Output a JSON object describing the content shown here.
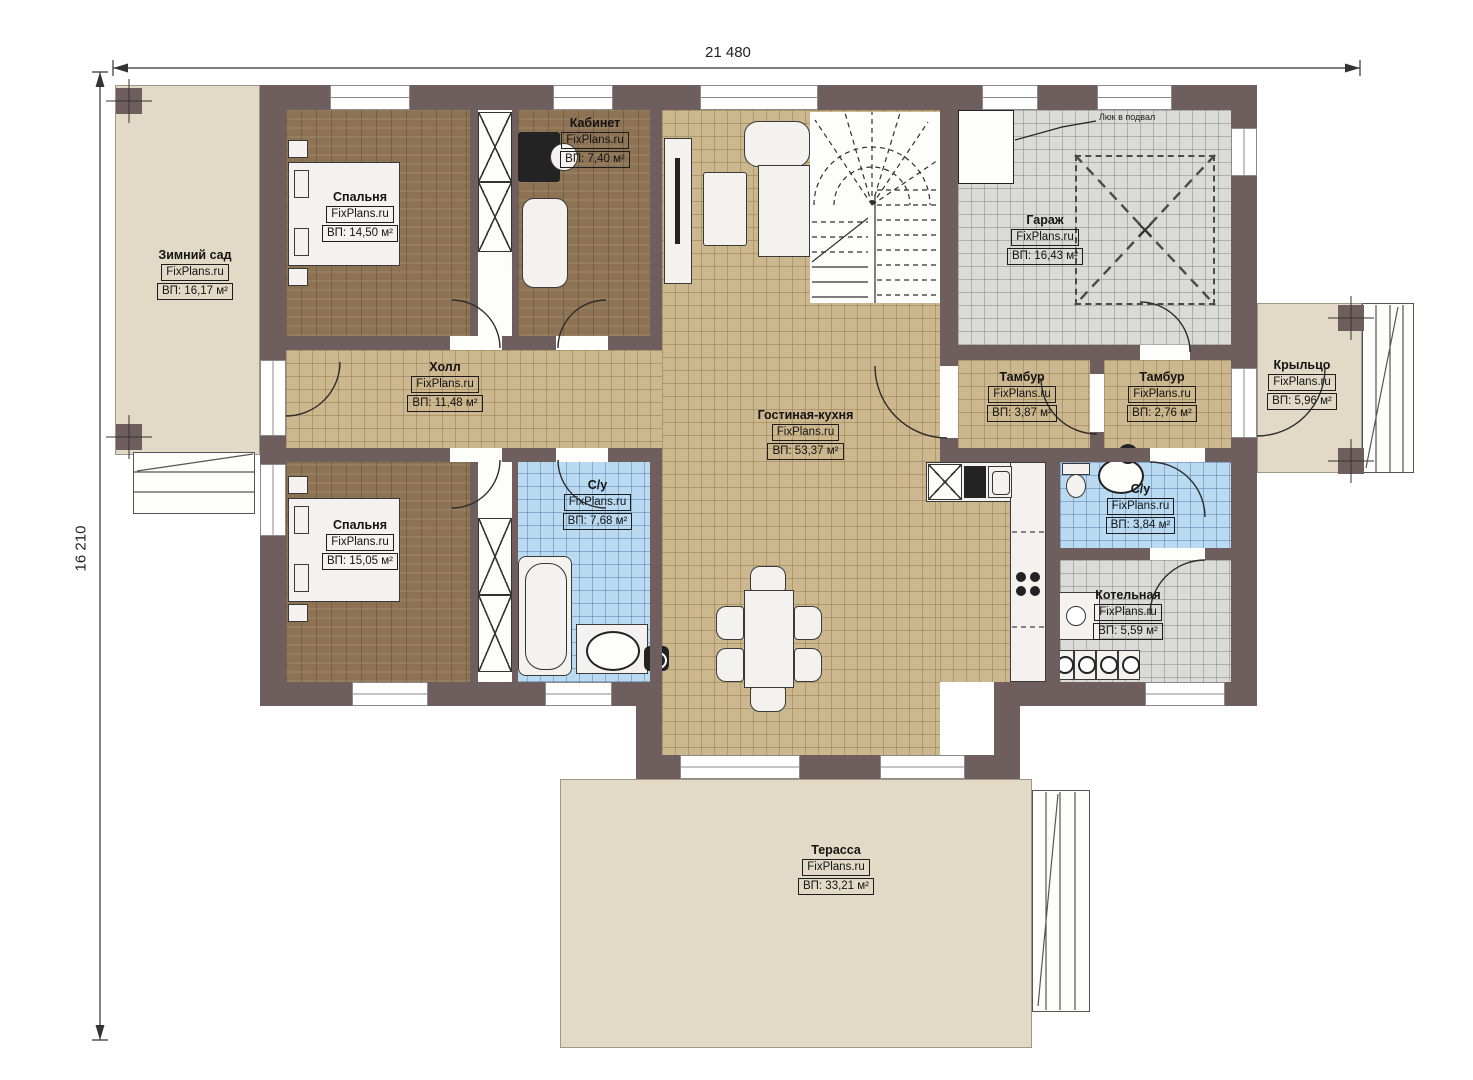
{
  "dimensions": {
    "width": "21 480",
    "height": "16 210"
  },
  "brand": "FixPlans.ru",
  "annotations": {
    "basement_hatch": "Люк в подвал"
  },
  "rooms": {
    "winter_garden": {
      "name": "Зимний сад",
      "area": "ВП: 16,17 м²"
    },
    "bedroom_top": {
      "name": "Спальня",
      "area": "ВП: 14,50 м²"
    },
    "office": {
      "name": "Кабинет",
      "area": "ВП: 7,40 м²"
    },
    "garage": {
      "name": "Гараж",
      "area": "ВП: 16,43 м²"
    },
    "hall": {
      "name": "Холл",
      "area": "ВП: 11,48 м²"
    },
    "living_kitchen": {
      "name": "Гостиная-кухня",
      "area": "ВП: 53,37 м²"
    },
    "tambour_left": {
      "name": "Тамбур",
      "area": "ВП: 3,87 м²"
    },
    "tambour_right": {
      "name": "Тамбур",
      "area": "ВП: 2,76 м²"
    },
    "porch": {
      "name": "Крыльцо",
      "area": "ВП: 5,96 м²"
    },
    "bedroom_bottom": {
      "name": "Спальня",
      "area": "ВП: 15,05 м²"
    },
    "bathroom_left": {
      "name": "С/у",
      "area": "ВП: 7,68 м²"
    },
    "bathroom_right": {
      "name": "С/у",
      "area": "ВП: 3,84 м²"
    },
    "boiler_room": {
      "name": "Котельная",
      "area": "ВП: 5,59 м²"
    },
    "terrace": {
      "name": "Терасса",
      "area": "ВП: 33,21 м²"
    }
  },
  "colors": {
    "wall": "#6f5e5e",
    "exterior_floor": "#e2dac6",
    "tile_tan": "#ccb78e",
    "tile_gray": "#dadad8",
    "tile_blue": "#badaf2",
    "wood": "#8d7354"
  }
}
